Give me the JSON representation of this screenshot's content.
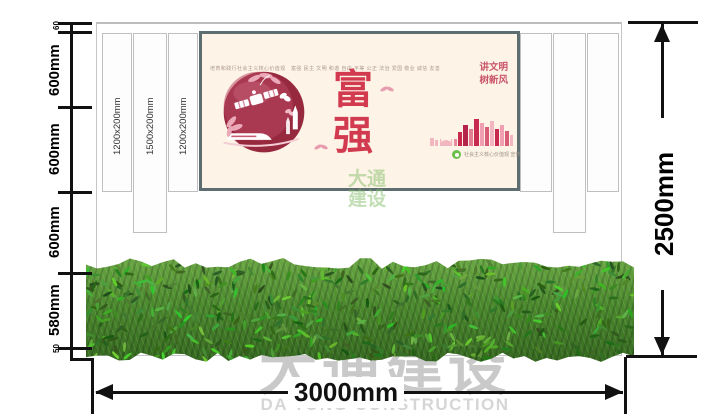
{
  "drawing": {
    "slat_labels": [
      "1200x200mm",
      "1500x200mm",
      "1200x200mm"
    ],
    "dim_left": [
      "60",
      "600mm",
      "600mm",
      "600mm",
      "580mm",
      "50"
    ],
    "dim_right": "2500mm",
    "dim_bottom": "3000mm"
  },
  "poster": {
    "header_line": "培育和践行社会主义核心价值观　富强 民主 文明 和谐 自由 平等 公正 法治 爱国 敬业 诚信 友善",
    "main_word": "富强",
    "side_slogan_line1": "讲文明",
    "side_slogan_line2": "树新风",
    "caption": "社会主义核心价值观 宣传"
  },
  "watermark": {
    "cn": "大通建设",
    "en": "DA TONG CONSTRUCTION",
    "small_line1": "大通",
    "small_line2": "建设"
  },
  "colors": {
    "accent_red": "#d23a50",
    "poster_bg": "#fdf3e6",
    "poster_border": "#5d6d70",
    "hedge_green": "#4c8a2e",
    "logo_green": "#6abf4b",
    "watermark_gray": "#c9c9c9",
    "line_black": "#111111"
  }
}
